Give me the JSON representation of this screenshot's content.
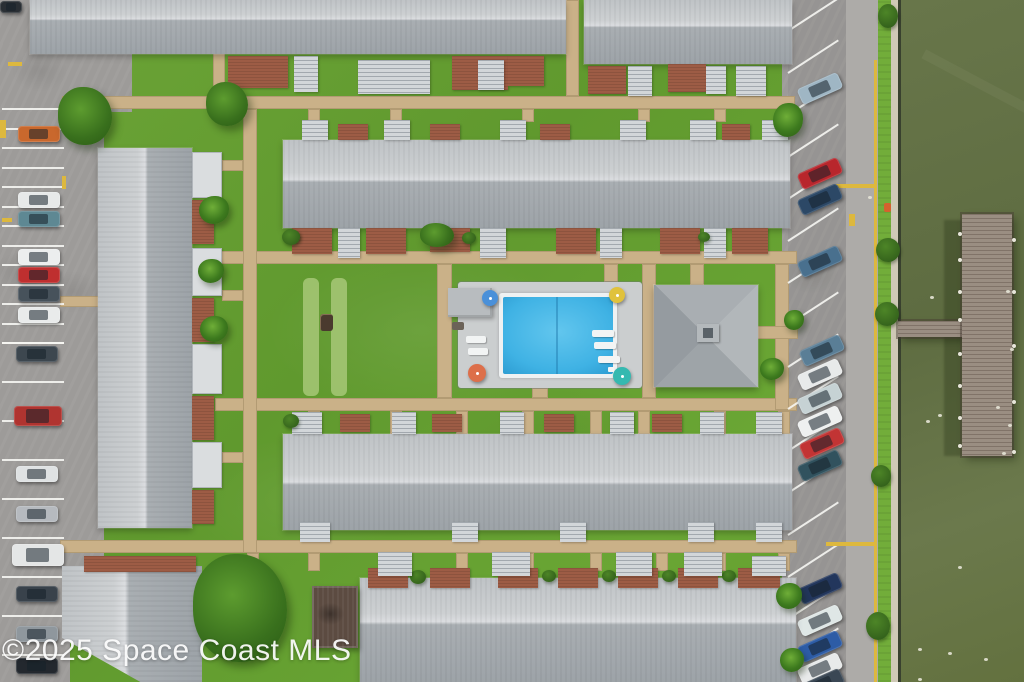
{
  "watermark": {
    "text": "©2025 Space Coast MLS"
  },
  "palette": {
    "grass": "#66a132",
    "walkway": "#cab188",
    "asphalt": "#9d9b99",
    "road_lane": "#adaba8",
    "roof_light": "#c6c9cc",
    "roof_dark": "#9fa5aa",
    "brick_patio": "#9d5c45",
    "pool_water": "#3fb2e4",
    "pool_deck": "#cbcecf",
    "lake_water": "#62703f",
    "dock_wood": "#9a8e82",
    "stripe_white": "#f6f6f3",
    "marking_yellow": "#ddb83e"
  },
  "scene": {
    "asphalt": [
      [
        0,
        0,
        70,
        682
      ],
      [
        0,
        44,
        132,
        68
      ],
      [
        60,
        108,
        44,
        460
      ]
    ],
    "road": {
      "base": [
        782,
        0,
        98,
        682
      ],
      "lane": [
        846,
        0,
        32,
        682
      ],
      "stall_shade": [
        788,
        0,
        58,
        682
      ],
      "stall_stripes": {
        "x": 788,
        "y0": -12,
        "y1": 690,
        "step": 42,
        "len": 60,
        "angle": -33
      }
    },
    "verge": [
      878,
      0,
      14,
      682
    ],
    "seawall": [
      891,
      0,
      8,
      682
    ],
    "wall_shadow": [
      898,
      0,
      4,
      682
    ],
    "water": [
      901,
      0,
      123,
      682
    ],
    "wake": [
      915,
      84,
      150,
      10
    ],
    "dock": {
      "main": [
        962,
        214,
        50,
        242
      ],
      "walkway": [
        898,
        321,
        66,
        16
      ],
      "shadow": [
        944,
        220,
        18,
        236
      ],
      "posts": [
        [
          958,
          232
        ],
        [
          958,
          258
        ],
        [
          958,
          290
        ],
        [
          958,
          318
        ],
        [
          958,
          352
        ],
        [
          958,
          384
        ],
        [
          958,
          416
        ],
        [
          958,
          444
        ],
        [
          1012,
          238
        ],
        [
          1012,
          290
        ],
        [
          1012,
          344
        ],
        [
          1012,
          400
        ],
        [
          1012,
          450
        ]
      ]
    },
    "specks": [
      [
        1006,
        290
      ],
      [
        1010,
        348
      ],
      [
        1008,
        424
      ],
      [
        1002,
        452
      ],
      [
        930,
        296
      ],
      [
        926,
        420
      ],
      [
        918,
        648
      ],
      [
        948,
        652
      ],
      [
        984,
        658
      ],
      [
        938,
        414
      ],
      [
        996,
        406
      ],
      [
        918,
        678
      ],
      [
        958,
        566
      ],
      [
        868,
        196
      ]
    ],
    "walkways": [
      [
        62,
        96,
        733,
        13
      ],
      [
        215,
        251,
        582,
        13
      ],
      [
        215,
        398,
        582,
        13
      ],
      [
        60,
        540,
        737,
        13
      ],
      [
        243,
        109,
        14,
        444
      ],
      [
        437,
        264,
        15,
        134
      ],
      [
        642,
        264,
        14,
        134
      ],
      [
        775,
        264,
        14,
        146
      ],
      [
        566,
        0,
        13,
        96
      ],
      [
        213,
        52,
        12,
        44
      ],
      [
        308,
        109,
        12,
        13
      ],
      [
        390,
        109,
        12,
        13
      ],
      [
        522,
        109,
        12,
        13
      ],
      [
        638,
        109,
        12,
        13
      ],
      [
        714,
        109,
        12,
        13
      ],
      [
        778,
        109,
        12,
        13
      ],
      [
        308,
        411,
        12,
        23
      ],
      [
        390,
        411,
        12,
        23
      ],
      [
        456,
        411,
        12,
        23
      ],
      [
        522,
        411,
        12,
        23
      ],
      [
        590,
        411,
        12,
        23
      ],
      [
        638,
        411,
        12,
        23
      ],
      [
        714,
        411,
        12,
        23
      ],
      [
        778,
        411,
        12,
        23
      ],
      [
        247,
        553,
        12,
        16
      ],
      [
        308,
        553,
        12,
        18
      ],
      [
        390,
        553,
        12,
        18
      ],
      [
        456,
        553,
        12,
        18
      ],
      [
        522,
        553,
        12,
        18
      ],
      [
        590,
        553,
        12,
        18
      ],
      [
        656,
        553,
        12,
        18
      ],
      [
        714,
        553,
        12,
        18
      ],
      [
        778,
        553,
        12,
        18
      ],
      [
        604,
        264,
        14,
        18
      ],
      [
        532,
        388,
        16,
        10
      ],
      [
        690,
        264,
        14,
        21
      ],
      [
        756,
        326,
        42,
        13
      ],
      [
        222,
        160,
        21,
        11
      ],
      [
        222,
        290,
        21,
        11
      ],
      [
        222,
        452,
        21,
        11
      ],
      [
        60,
        296,
        40,
        11
      ]
    ],
    "lawn_stripes": [
      [
        303,
        278,
        16,
        118
      ],
      [
        331,
        278,
        16,
        118
      ]
    ],
    "bench": [
      320,
      314,
      13,
      17
    ],
    "left_parking": {
      "stripe_x": 2,
      "stripe_w": 62,
      "dense": [
        108,
        342,
        19.5
      ],
      "sparse": [
        342,
        682,
        39
      ],
      "cars": [
        [
          18,
          126,
          "#c9682d"
        ],
        [
          18,
          192,
          "#e7e9e9"
        ],
        [
          18,
          211,
          "#5e8893"
        ],
        [
          18,
          249,
          "#eceeee"
        ],
        [
          18,
          267,
          "#bf2f2f"
        ],
        [
          18,
          286,
          "#47525b"
        ],
        [
          18,
          307,
          "#e9ebeb"
        ],
        [
          16,
          346,
          "#3d474f"
        ],
        [
          14,
          406,
          "#b03430",
          48,
          20
        ],
        [
          16,
          466,
          "#dfe2e3"
        ],
        [
          16,
          506,
          "#b6babf"
        ],
        [
          12,
          544,
          "#e4e6e6",
          52,
          22
        ],
        [
          16,
          586,
          "#39424b"
        ],
        [
          16,
          626,
          "#8f979d"
        ],
        [
          16,
          658,
          "#23282e"
        ],
        [
          0,
          1,
          "#2a2f34",
          22,
          12
        ]
      ]
    },
    "yellow_markings": [
      [
        8,
        62,
        14,
        4
      ],
      [
        62,
        176,
        4,
        13
      ],
      [
        2,
        218,
        10,
        4
      ],
      [
        0,
        120,
        6,
        18
      ],
      [
        874,
        60,
        3,
        622
      ],
      [
        836,
        184,
        40,
        4
      ],
      [
        826,
        542,
        50,
        4
      ],
      [
        849,
        214,
        6,
        12
      ]
    ],
    "hydrant": [
      884,
      203,
      7,
      9
    ],
    "right_cars": [
      [
        798,
        80,
        "#9fb6c4"
      ],
      [
        798,
        165,
        "#b8262c"
      ],
      [
        798,
        191,
        "#2c4866"
      ],
      [
        798,
        253,
        "#49708e"
      ],
      [
        800,
        342,
        "#5a7e96"
      ],
      [
        798,
        366,
        "#e8eaea"
      ],
      [
        798,
        390,
        "#c6d2d4"
      ],
      [
        798,
        413,
        "#eef0f0"
      ],
      [
        800,
        435,
        "#c23434"
      ],
      [
        798,
        457,
        "#31525e"
      ],
      [
        798,
        580,
        "#22365c"
      ],
      [
        798,
        612,
        "#dfe7e6"
      ],
      [
        798,
        638,
        "#2d5ca6"
      ],
      [
        798,
        660,
        "#e8eaea"
      ],
      [
        800,
        676,
        "#3a4754"
      ]
    ],
    "pool": {
      "deck": [
        458,
        282,
        184,
        106
      ],
      "coping": [
        499,
        293,
        118,
        85
      ],
      "water": [
        503,
        297,
        110,
        77
      ],
      "seam_x": 556,
      "pavilion": [
        448,
        288,
        44,
        29
      ],
      "table": [
        452,
        322,
        12,
        8
      ],
      "loungers": [
        [
          466,
          336,
          20,
          7
        ],
        [
          468,
          348,
          20,
          7
        ],
        [
          592,
          330,
          22,
          7
        ],
        [
          594,
          342,
          22,
          7
        ],
        [
          598,
          356,
          22,
          7
        ]
      ],
      "umbrellas": [
        [
          490,
          298,
          8,
          "#4a90d9"
        ],
        [
          617,
          295,
          8,
          "#e0c23c"
        ],
        [
          477,
          373,
          9,
          "#dd6f4a"
        ],
        [
          622,
          376,
          9,
          "#35b9b0"
        ]
      ],
      "ladder": [
        608,
        367,
        6,
        5
      ]
    },
    "clubhouse": {
      "roof": [
        654,
        285,
        104,
        102
      ],
      "cupola": [
        697,
        324,
        22,
        18
      ],
      "cupola_inner": [
        703,
        328,
        10,
        10
      ]
    },
    "shed": [
      312,
      586,
      46,
      62
    ],
    "buildings": [
      [
        30,
        0,
        536,
        54,
        "h",
        35
      ],
      [
        584,
        0,
        208,
        64,
        "h",
        40
      ],
      [
        283,
        140,
        507,
        88,
        "h",
        45
      ],
      [
        98,
        148,
        94,
        380,
        "v",
        50
      ],
      [
        283,
        434,
        509,
        96,
        "h",
        50
      ],
      [
        62,
        566,
        140,
        116,
        "v",
        45,
        "clip"
      ],
      [
        360,
        578,
        436,
        104,
        "h",
        42
      ]
    ],
    "blocks": [
      [
        "b",
        228,
        56,
        60,
        32
      ],
      [
        "s",
        294,
        56,
        24,
        36
      ],
      [
        "s",
        358,
        60,
        72,
        34
      ],
      [
        "b",
        452,
        56,
        56,
        34
      ],
      [
        "s",
        478,
        60,
        26,
        30
      ],
      [
        "b",
        508,
        56,
        36,
        30
      ],
      [
        "b",
        588,
        66,
        38,
        28
      ],
      [
        "s",
        628,
        66,
        24,
        30
      ],
      [
        "b",
        668,
        64,
        38,
        28
      ],
      [
        "s",
        706,
        66,
        20,
        28
      ],
      [
        "s",
        736,
        66,
        30,
        30
      ],
      [
        "s",
        302,
        120,
        26,
        20
      ],
      [
        "b",
        338,
        124,
        30,
        16
      ],
      [
        "s",
        384,
        120,
        26,
        20
      ],
      [
        "b",
        430,
        124,
        30,
        16
      ],
      [
        "s",
        500,
        120,
        26,
        20
      ],
      [
        "b",
        540,
        124,
        30,
        16
      ],
      [
        "s",
        620,
        120,
        26,
        20
      ],
      [
        "s",
        690,
        120,
        26,
        20
      ],
      [
        "b",
        722,
        124,
        28,
        16
      ],
      [
        "s",
        762,
        120,
        26,
        20
      ],
      [
        "b",
        292,
        228,
        40,
        26
      ],
      [
        "s",
        338,
        228,
        22,
        30
      ],
      [
        "b",
        366,
        228,
        40,
        26
      ],
      [
        "b",
        430,
        228,
        40,
        24
      ],
      [
        "s",
        480,
        228,
        26,
        30
      ],
      [
        "b",
        556,
        228,
        40,
        26
      ],
      [
        "s",
        600,
        228,
        22,
        30
      ],
      [
        "b",
        660,
        228,
        40,
        26
      ],
      [
        "s",
        704,
        228,
        22,
        30
      ],
      [
        "b",
        732,
        228,
        36,
        26
      ],
      [
        "g",
        286,
        230,
        14,
        12
      ],
      [
        "g",
        462,
        232,
        14,
        12
      ],
      [
        "g",
        698,
        232,
        12,
        10
      ],
      [
        "s",
        292,
        412,
        30,
        22
      ],
      [
        "b",
        340,
        414,
        30,
        18
      ],
      [
        "s",
        392,
        412,
        24,
        22
      ],
      [
        "b",
        432,
        414,
        30,
        18
      ],
      [
        "s",
        500,
        412,
        24,
        22
      ],
      [
        "b",
        544,
        414,
        30,
        18
      ],
      [
        "s",
        610,
        412,
        24,
        22
      ],
      [
        "b",
        652,
        414,
        30,
        18
      ],
      [
        "s",
        700,
        412,
        24,
        22
      ],
      [
        "s",
        756,
        412,
        26,
        22
      ],
      [
        "g",
        283,
        414,
        16,
        14
      ],
      [
        "s",
        300,
        522,
        30,
        20
      ],
      [
        "s",
        452,
        522,
        26,
        20
      ],
      [
        "s",
        560,
        522,
        26,
        20
      ],
      [
        "s",
        688,
        522,
        26,
        20
      ],
      [
        "s",
        756,
        522,
        26,
        20
      ],
      [
        "w",
        192,
        152,
        30,
        46
      ],
      [
        "b",
        192,
        200,
        22,
        44
      ],
      [
        "w",
        192,
        248,
        30,
        48
      ],
      [
        "b",
        192,
        298,
        22,
        44
      ],
      [
        "w",
        192,
        344,
        30,
        50
      ],
      [
        "b",
        192,
        396,
        22,
        44
      ],
      [
        "w",
        192,
        442,
        30,
        46
      ],
      [
        "b",
        192,
        490,
        22,
        34
      ],
      [
        "b",
        84,
        556,
        112,
        16
      ],
      [
        "b",
        368,
        568,
        40,
        20
      ],
      [
        "g",
        410,
        570,
        16,
        14
      ],
      [
        "b",
        430,
        568,
        40,
        20
      ],
      [
        "b",
        498,
        568,
        40,
        20
      ],
      [
        "g",
        542,
        570,
        14,
        12
      ],
      [
        "b",
        558,
        568,
        40,
        20
      ],
      [
        "g",
        602,
        570,
        14,
        12
      ],
      [
        "b",
        618,
        568,
        40,
        20
      ],
      [
        "g",
        662,
        570,
        14,
        12
      ],
      [
        "b",
        678,
        568,
        40,
        20
      ],
      [
        "g",
        722,
        570,
        14,
        12
      ],
      [
        "b",
        738,
        568,
        42,
        20
      ],
      [
        "s",
        378,
        552,
        34,
        24
      ],
      [
        "s",
        492,
        552,
        38,
        24
      ],
      [
        "s",
        616,
        552,
        36,
        24
      ],
      [
        "s",
        684,
        552,
        38,
        24
      ],
      [
        "s",
        752,
        556,
        34,
        20
      ]
    ],
    "trees": [
      [
        85,
        116,
        27,
        29,
        "tree"
      ],
      [
        227,
        104,
        21,
        22,
        "tree"
      ],
      [
        214,
        210,
        15,
        14,
        "palm"
      ],
      [
        211,
        271,
        13,
        12,
        "palm"
      ],
      [
        214,
        329,
        14,
        13,
        "palm"
      ],
      [
        291,
        237,
        9,
        8,
        "bush"
      ],
      [
        437,
        235,
        17,
        12,
        "tree"
      ],
      [
        772,
        369,
        12,
        11,
        "palm"
      ],
      [
        240,
        608,
        47,
        54,
        "tree"
      ],
      [
        788,
        120,
        15,
        17,
        "palm"
      ],
      [
        794,
        320,
        10,
        10,
        "palm"
      ],
      [
        789,
        596,
        13,
        13,
        "palm"
      ],
      [
        792,
        660,
        12,
        12,
        "palm"
      ],
      [
        888,
        250,
        12,
        12,
        "bush"
      ],
      [
        887,
        314,
        12,
        12,
        "bush"
      ],
      [
        881,
        476,
        10,
        11,
        "bush"
      ],
      [
        878,
        626,
        12,
        14,
        "bush"
      ],
      [
        888,
        16,
        10,
        12,
        "bush"
      ]
    ]
  }
}
